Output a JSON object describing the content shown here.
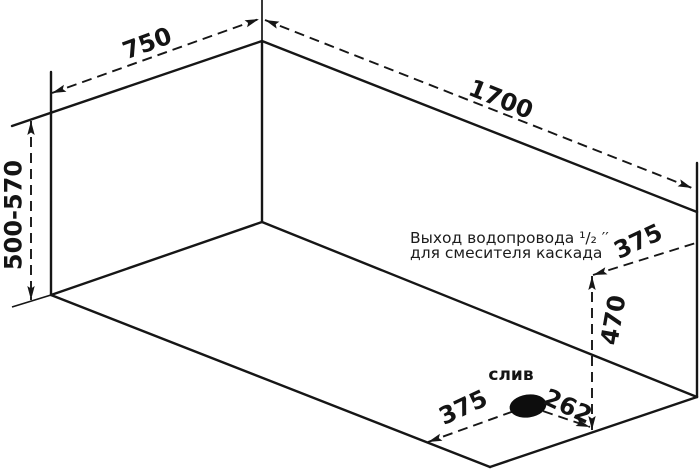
{
  "colors": {
    "line": "#161616",
    "background": "#ffffff"
  },
  "dimensions": {
    "top_width": "750",
    "top_length": "1700",
    "height_range": "500-570",
    "outlet_side_offset": "375",
    "outlet_height": "470",
    "drain_side_offset": "375",
    "drain_long_offset": "262"
  },
  "annotations": {
    "drain_label": "слив",
    "outlet_note_line1": "Выход водопровода ¹/₂ ′′",
    "outlet_note_line2": "для смесителя каскада"
  }
}
